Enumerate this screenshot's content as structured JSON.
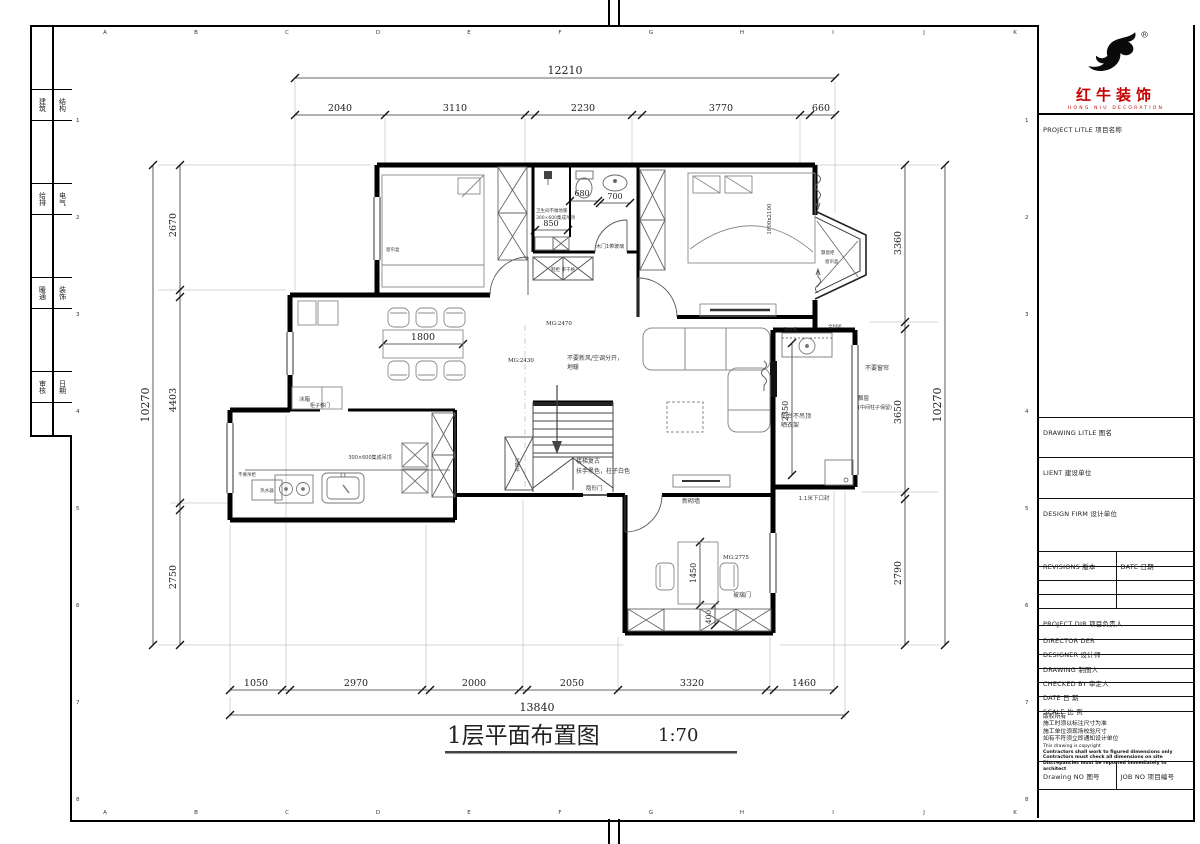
{
  "sheet": {
    "title": "1层平面布置图",
    "scale": "1:70",
    "grid_cols": [
      "A",
      "B",
      "C",
      "D",
      "E",
      "F",
      "G",
      "H",
      "I",
      "J",
      "K"
    ],
    "grid_rows": [
      "1",
      "2",
      "3",
      "4",
      "5",
      "6",
      "7",
      "8"
    ]
  },
  "side_strip": [
    {
      "a": "建筑",
      "b": "结构"
    },
    {
      "a": "给排",
      "b": "电气"
    },
    {
      "a": "暖通",
      "b": "装饰"
    },
    {
      "a": "审核",
      "b": "日期"
    }
  ],
  "titleblock": {
    "reg": "®",
    "brand_cn": "红牛装饰",
    "brand_en": "HONG NIU DECORATION",
    "project_title": "PROJECT LITLE  项目名称",
    "drawing_title": "DRAWING LITLE  图名",
    "client": "LIENT  建设单位",
    "design_firm": "DESIGN FIRM  设计单位",
    "revisions": "REVISIONS  版本",
    "date_col": "DATE  日期",
    "project_dir": "PROJECT DIR  项目负责人",
    "director": "DIRECTOR DER",
    "designer": "DESIGNER  设计师",
    "drawing_by": "DRAWING  制图人",
    "checked_by": "CHECKED BY  审定人",
    "date": "DATE  日 期",
    "scale_row": "SCALE  比 例",
    "notes": [
      "版权所有",
      "施工时须以标注尺寸为准",
      "施工单位须现场校验尺寸",
      "如有不符须立即通知设计单位",
      "This drawing is copyright",
      "Contractors shall work to figured dimensions only",
      "Contractors must check all dimensions on site",
      "Discrepancies must be reported immediately to architect"
    ],
    "drawing_no": "Drawing NO  图号",
    "job_no": "JOB NO  项目编号"
  },
  "dims": {
    "top_total": "12210",
    "top": [
      "2040",
      "3110",
      "2230",
      "3770",
      "660"
    ],
    "left_total": "10270",
    "left": [
      "2670",
      "4403",
      "2750"
    ],
    "right_total": "10270",
    "right": [
      "3360",
      "3650",
      "2790"
    ],
    "bottom_total": "13840",
    "bottom": [
      "1050",
      "2970",
      "2000",
      "2050",
      "3320",
      "1460"
    ],
    "shower": "850",
    "toilet": "680",
    "basin": "700",
    "table": "1800",
    "desk": "1450",
    "desk_off": "400",
    "balcony": "2350",
    "bed_size": "1800x2100"
  },
  "labels": {
    "curtain_box": "窗帘盒",
    "bath1": "卫生间不做地暖",
    "bath2": "300×600集成吊顶",
    "bath_door": "木门1带玻璃",
    "shoe": "鞋柜 带千格",
    "mg_hall": "MG:2470",
    "mg_living": "MG:2430",
    "mg_study": "MG:2775",
    "hvac1": "不要新风/空调分开，",
    "hvac2": "地暖",
    "stair1": "楼梯复古",
    "stair2": "扶手黑色，柱子白色",
    "hidden_door": "隐形门",
    "new_wall": "新砌墙",
    "glass_door": "玻璃门",
    "balcony1": "阳台不吊顶",
    "balcony2": "晒衣架",
    "washer": "洗衣机",
    "seal": "1.1米下口封",
    "enclosed": "全封闭",
    "no_curtain": "不要窗帘",
    "bay1": "飘窗",
    "bay2": "(中间柱子保留)",
    "bay_seat": "飘窗柜",
    "bay_curtain": "窗帘盒",
    "fridge": "冰箱",
    "heater": "热水器",
    "cab_door": "柜子移门",
    "kitchen_ceiling": "300×600集成吊顶",
    "no_upper": "不要吊柜",
    "closet": "衣帽间"
  }
}
